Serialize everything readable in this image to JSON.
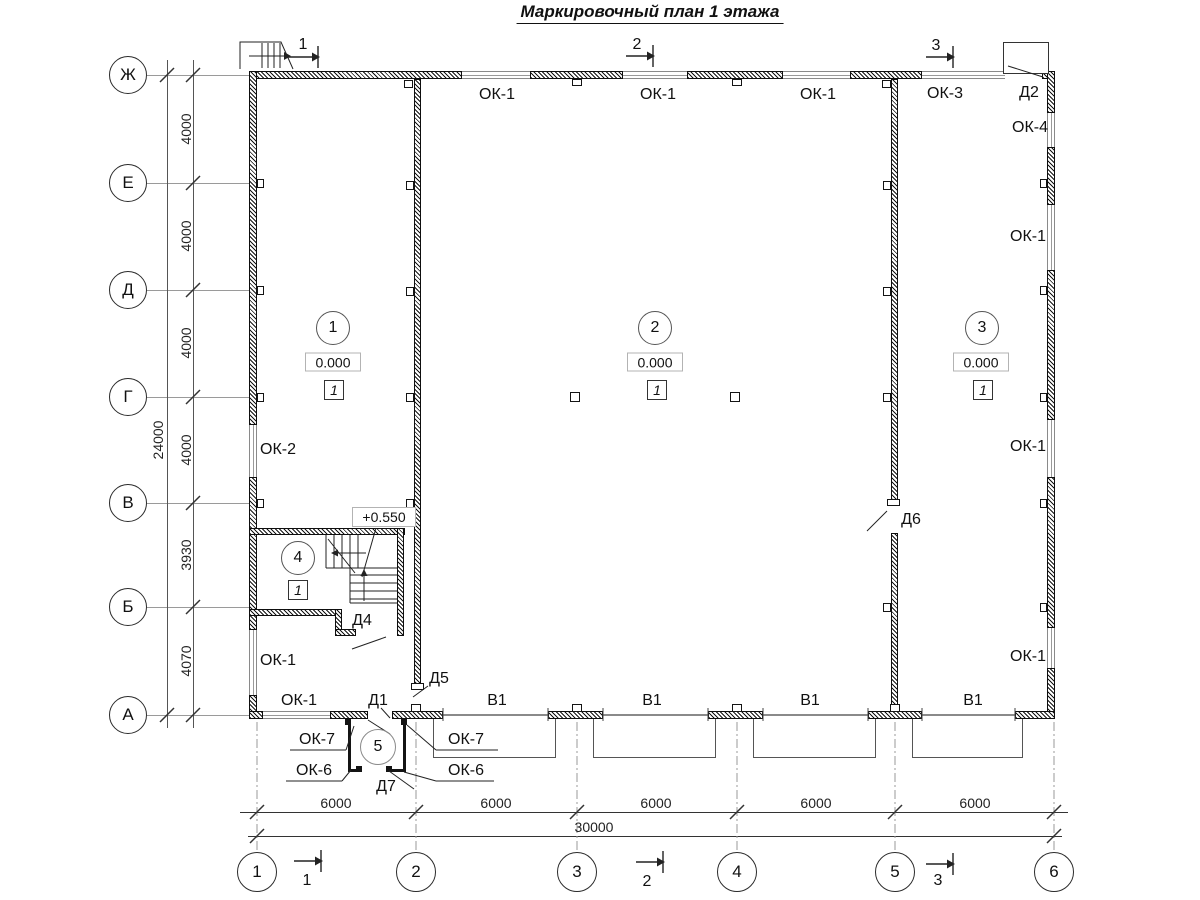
{
  "title": "Маркировочный план 1 этажа",
  "grid": {
    "row_axes": [
      "Ж",
      "Е",
      "Д",
      "Г",
      "В",
      "Б",
      "А"
    ],
    "row_dimensions": [
      "4000",
      "4000",
      "4000",
      "4000",
      "3930",
      "4070"
    ],
    "row_total": "24000",
    "column_axes": [
      "1",
      "2",
      "3",
      "4",
      "5",
      "6"
    ],
    "column_dimensions": [
      "6000",
      "6000",
      "6000",
      "6000",
      "6000"
    ],
    "column_total": "30000"
  },
  "section_marks": {
    "s1": "1",
    "s2": "2",
    "s3": "3"
  },
  "rooms": {
    "room1": {
      "number": "1",
      "elevation": "0.000",
      "floor_type": "1"
    },
    "room2": {
      "number": "2",
      "elevation": "0.000",
      "floor_type": "1"
    },
    "room3": {
      "number": "3",
      "elevation": "0.000",
      "floor_type": "1"
    },
    "room4": {
      "number": "4",
      "floor_type": "1"
    },
    "room5": {
      "number": "5"
    }
  },
  "stair": {
    "landing_elevation": "+0.550"
  },
  "openings": {
    "top_wall": {
      "w1": "ОК-1",
      "w2": "ОК-1",
      "w3": "ОК-1",
      "w4": "ОК-3",
      "door": "Д2"
    },
    "right_wall": {
      "w1": "ОК-4",
      "w2": "ОК-1",
      "w3": "ОК-1",
      "w4": "ОК-1"
    },
    "left_wall": {
      "w1": "ОК-2",
      "w2": "ОК-1"
    },
    "bottom_wall": {
      "w1": "ОК-1",
      "door": "Д1",
      "g1": "В1",
      "g2": "В1",
      "g3": "В1",
      "g4": "В1"
    },
    "interior": {
      "d4": "Д4",
      "d5": "Д5",
      "d6": "Д6",
      "d7": "Д7"
    },
    "vestibule": {
      "ok7_left": "ОК-7",
      "ok6_left": "ОК-6",
      "ok7_right": "ОК-7",
      "ok6_right": "ОК-6"
    }
  }
}
